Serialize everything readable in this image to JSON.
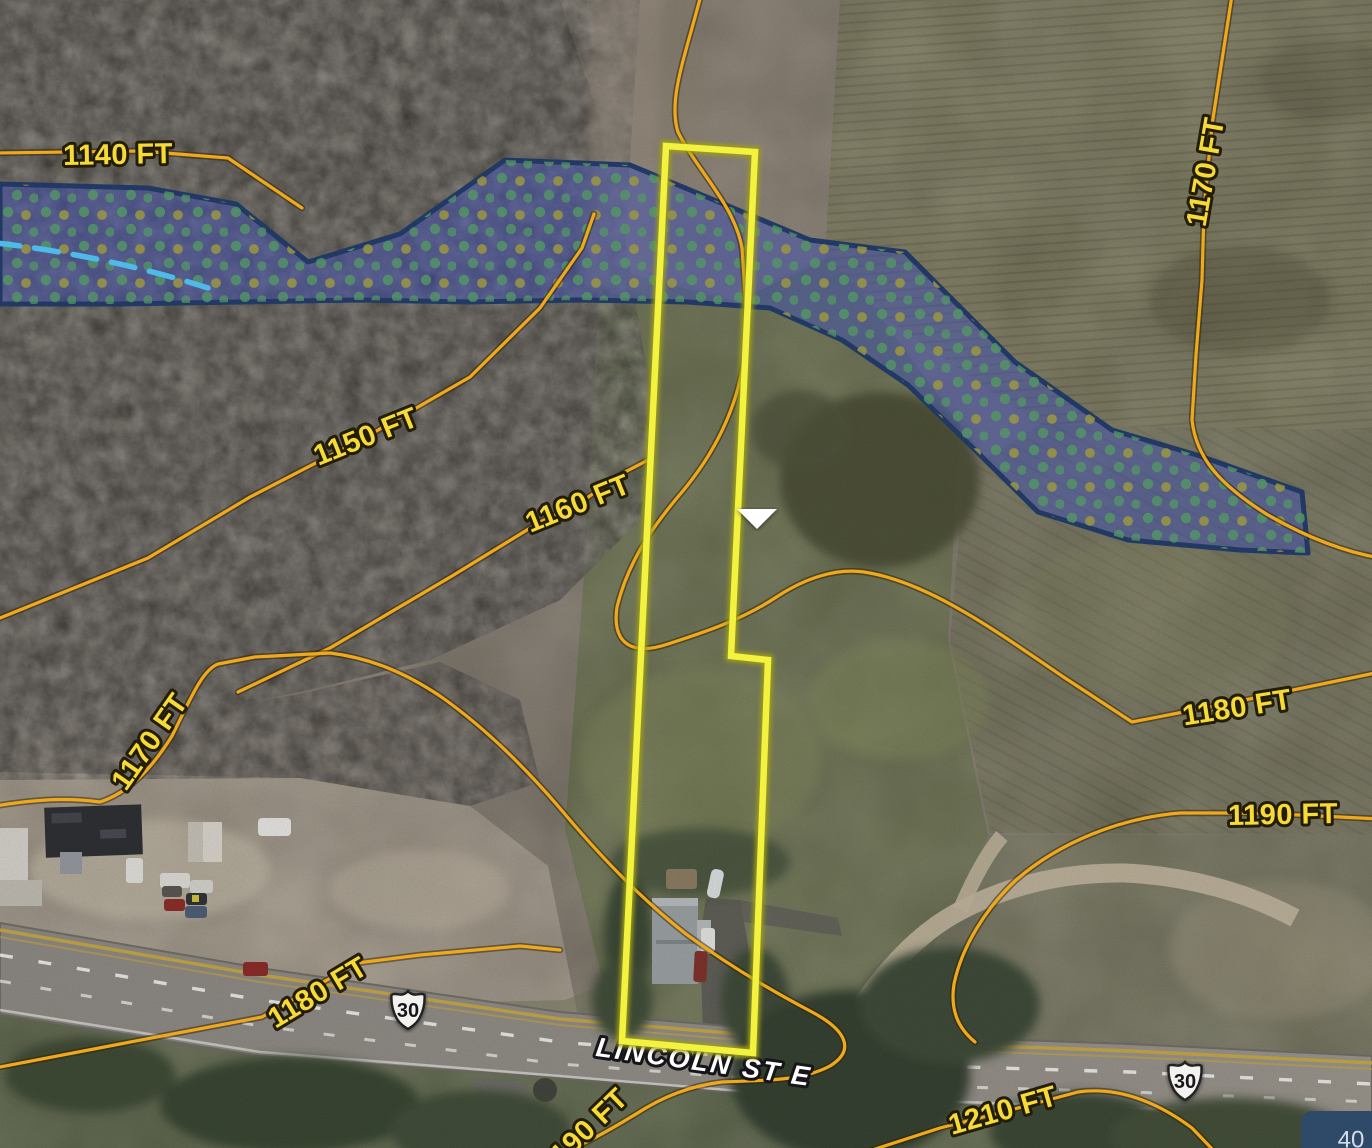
{
  "map": {
    "title": "Aerial parcel map with topographic contours and wetland overlay",
    "contour_labels": [
      {
        "text": "1140 FT",
        "elevation_ft": 1140
      },
      {
        "text": "1150 FT",
        "elevation_ft": 1150
      },
      {
        "text": "1160 FT",
        "elevation_ft": 1160
      },
      {
        "text": "1170 FT",
        "elevation_ft": 1170
      },
      {
        "text": "1170 FT",
        "elevation_ft": 1170
      },
      {
        "text": "1180 FT",
        "elevation_ft": 1180
      },
      {
        "text": "1180 FT",
        "elevation_ft": 1180
      },
      {
        "text": "1190 FT",
        "elevation_ft": 1190
      },
      {
        "text": "1190 FT",
        "elevation_ft": 1190
      },
      {
        "text": "1210 FT",
        "elevation_ft": 1210
      }
    ],
    "road": {
      "name": "LINCOLN ST E",
      "shields": [
        {
          "system": "US Route",
          "number": "30"
        },
        {
          "system": "US Route",
          "number": "30"
        }
      ]
    },
    "marker": {
      "shape": "triangle-down",
      "color": "#ffffff"
    },
    "corner_panel": {
      "value": "40"
    },
    "colors": {
      "parcel_outline": "#f3f23f",
      "wetland_fill": "#4053c0",
      "wetland_border": "#1b3668",
      "wetland_dot_green": "#55a06a",
      "wetland_dot_olive": "#a6a441",
      "contour": "#f0a91c",
      "contour_label": "#f7da35",
      "flow_line": "#4fb9e9",
      "road_label": "#ffffff"
    }
  }
}
